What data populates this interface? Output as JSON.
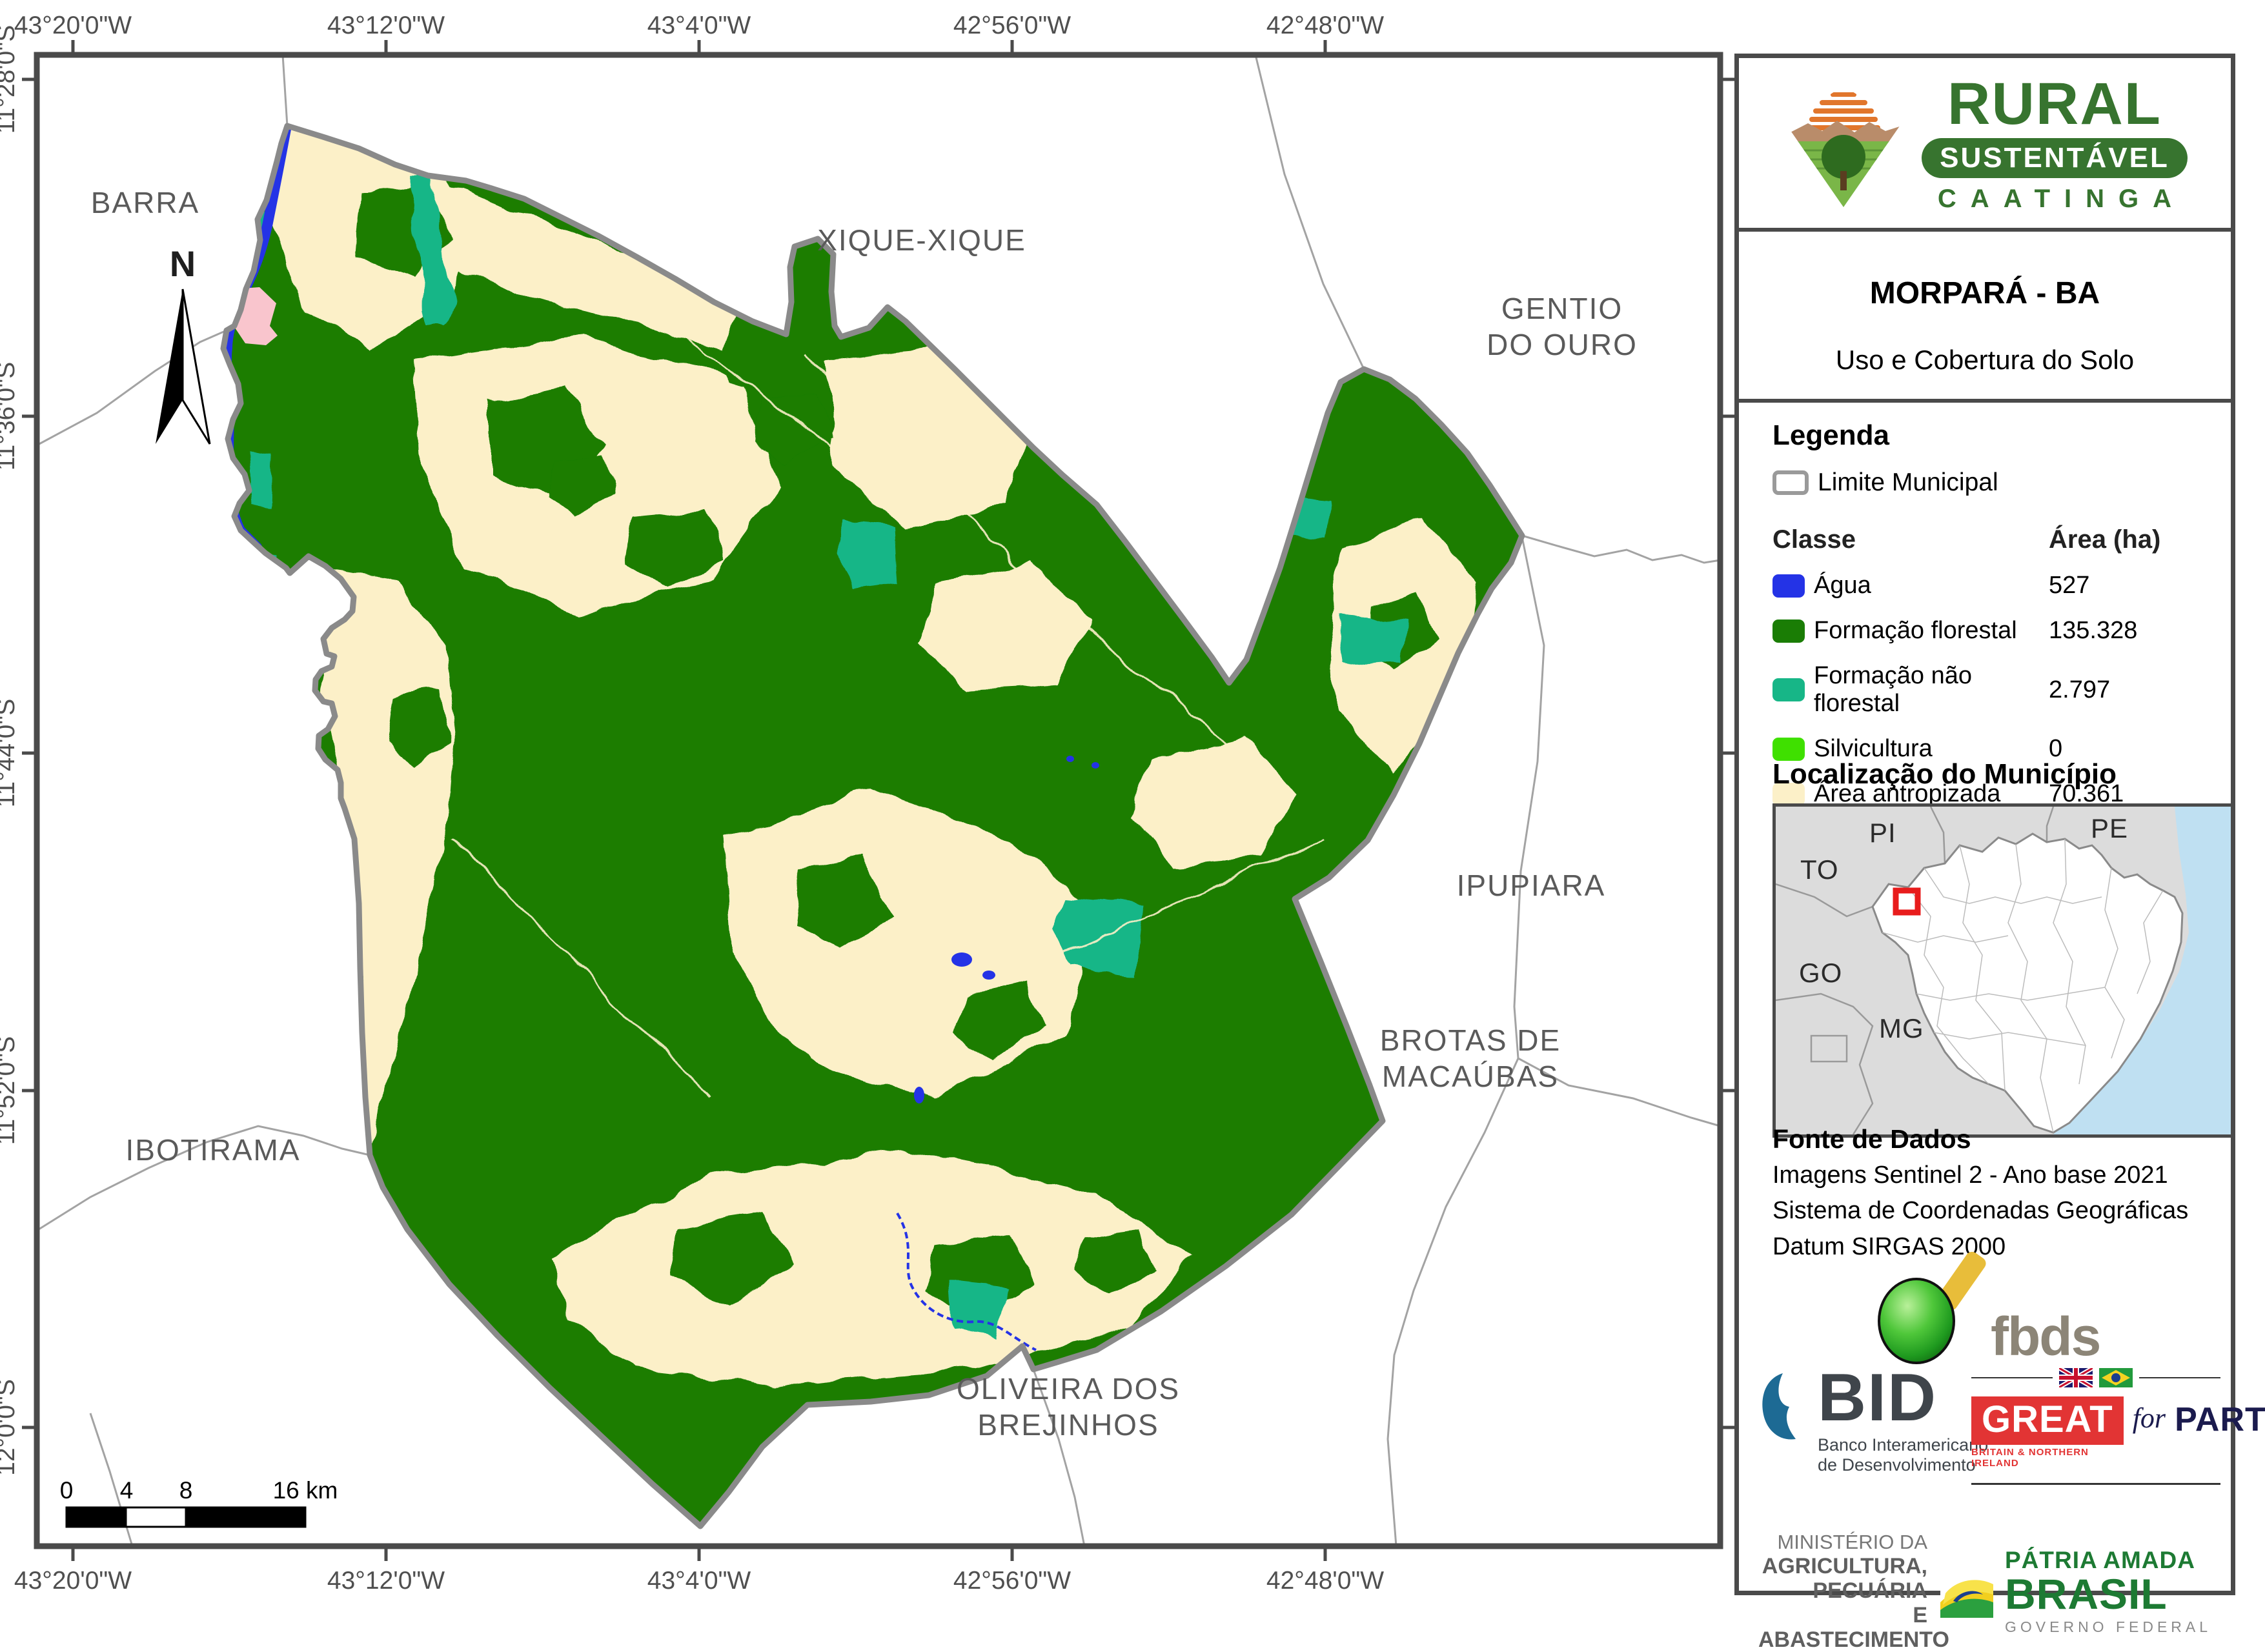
{
  "header": {
    "brand": {
      "line1": "RURAL",
      "line2": "SUSTENTÁVEL",
      "line3": "CAATINGA"
    },
    "title": "MORPARÁ - BA",
    "subtitle": "Uso e Cobertura do Solo"
  },
  "legend": {
    "heading": "Legenda",
    "limite_label": "Limite Municipal",
    "col_class": "Classe",
    "col_area": "Área (ha)",
    "classes": [
      {
        "label": "Água",
        "value": "527",
        "color": "#2433e6"
      },
      {
        "label": "Formação florestal",
        "value": "135.328",
        "color": "#1a7d05"
      },
      {
        "label": "Formação não florestal",
        "value": "2.797",
        "color": "#17b687"
      },
      {
        "label": "Silvicultura",
        "value": "0",
        "color": "#3fe000"
      },
      {
        "label": "Área antropizada",
        "value": "70.361",
        "color": "#fcf0c8"
      },
      {
        "label": "Área edificada",
        "value": "148",
        "color": "#f9c5cd"
      }
    ]
  },
  "location": {
    "heading": "Localização do Município",
    "states": {
      "pi": "PI",
      "pe": "PE",
      "to": "TO",
      "go": "GO",
      "mg": "MG"
    },
    "marker_color": "#e81c1c",
    "ocean_color": "#bfe0f2"
  },
  "source": {
    "heading": "Fonte de Dados",
    "lines": [
      "Imagens Sentinel 2 - Ano base 2021",
      "Sistema de Coordenadas Geográficas",
      "Datum SIRGAS 2000"
    ]
  },
  "logos": {
    "fbds": "fbds",
    "bid": {
      "name": "BID",
      "sub1": "Banco Interamericano",
      "sub2": "de Desenvolvimento"
    },
    "great": {
      "word": "GREAT",
      "for_word": "for",
      "partnership": "PARTNERSHIP",
      "sub": "BRITAIN & NORTHERN IRELAND"
    },
    "ministry": {
      "l1": "MINISTÉRIO DA",
      "l2": "AGRICULTURA, PECUÁRIA",
      "l3": "E ABASTECIMENTO"
    },
    "patria": {
      "l1": "PÁTRIA AMADA",
      "l2": "BRASIL",
      "l3": "GOVERNO FEDERAL"
    }
  },
  "map": {
    "north_letter": "N",
    "lon": [
      "43°20'0\"W",
      "43°12'0\"W",
      "43°4'0\"W",
      "42°56'0\"W",
      "42°48'0\"W"
    ],
    "lat": [
      "11°28'0\"S",
      "11°36'0\"S",
      "11°44'0\"S",
      "11°52'0\"S",
      "12°0'0\"S"
    ],
    "neighbors": {
      "barra": "BARRA",
      "xique": "XIQUE-XIQUE",
      "gentio_1": "GENTIO",
      "gentio_2": "DO OURO",
      "ipupiara": "IPUPIARA",
      "brotas_1": "BROTAS DE",
      "brotas_2": "MACAÚBAS",
      "oliveira_1": "OLIVEIRA DOS",
      "oliveira_2": "BREJINHOS",
      "ibotirama": "IBOTIRAMA"
    },
    "scalebar": {
      "t0": "0",
      "t4": "4",
      "t8": "8",
      "t16": "16 km"
    }
  }
}
